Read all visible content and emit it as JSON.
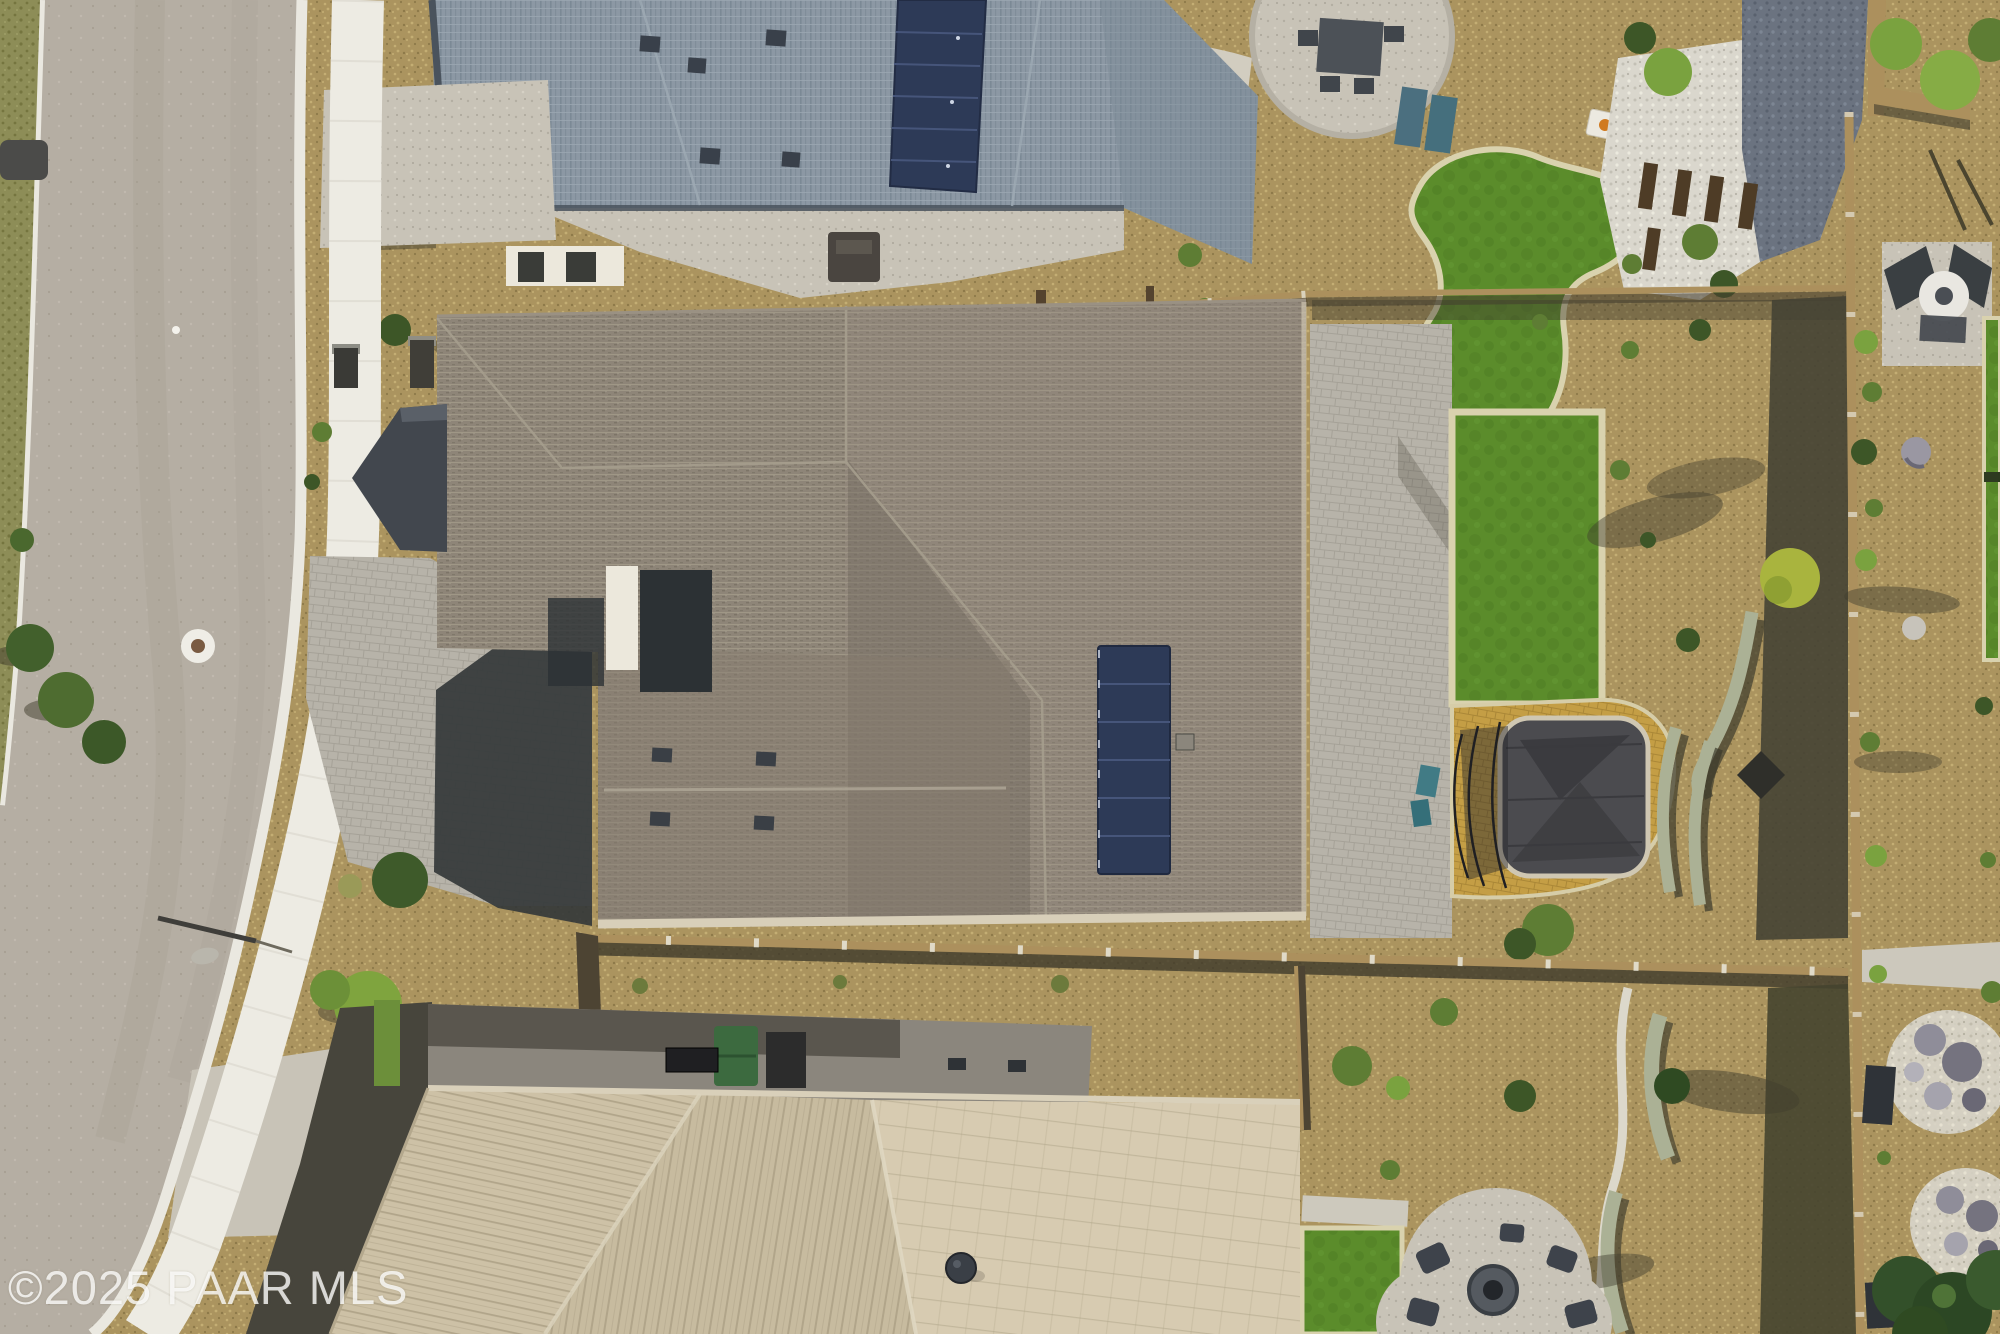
{
  "photo": {
    "type": "aerial-drone-photograph",
    "subject": "residential neighborhood rooftops and backyards, top-down view",
    "watermark": "©2025 PAAR MLS"
  },
  "scene": {
    "road": "curved street with white curbs and sidewalk on left",
    "houses": [
      {
        "label": "blue-gray shingle roof house with solar panels",
        "position": "top"
      },
      {
        "label": "taupe shingle roof house with solar panel strip and white courtyard",
        "position": "center"
      },
      {
        "label": "tan tile roof house with flat utility roof",
        "position": "bottom"
      }
    ],
    "features": [
      "solar-panel-array-top-roof",
      "solar-panel-array-center-roof",
      "artificial-turf-lawn",
      "putting-green-with-cornhole-boards",
      "trampoline-with-net",
      "fire-pit-patio-with-chairs",
      "circular-paver-patio-with-dining-set",
      "round-white-table-under-pergola",
      "desert-gravel-landscaping",
      "privacy-walls-and-fences",
      "serpentine-seat-walls",
      "rock-gardens",
      "street-light",
      "manhole-cover",
      "green-trash-bin",
      "blue-trash-bin",
      "rooftop-dumpster",
      "satellite-dish"
    ]
  },
  "palette": {
    "road": "#b5aea3",
    "road-dark": "#a79f93",
    "curb": "#eae8e0",
    "sidewalk": "#edebe3",
    "concrete": "#c8c3b7",
    "pavers": "#b7b3a9",
    "paver-line": "#a5a197",
    "gravel": "#ab945f",
    "gravel-light": "#c4ae74",
    "gravel-dark": "#8d7949",
    "grass": "#8d8d57",
    "grass-dark": "#75753f",
    "shadow": "#413d2e",
    "roof-blue": "#8c98a4",
    "roof-blue-dark": "#7b8995",
    "roof-blue-deep": "#4a535d",
    "solar": "#2d3a57",
    "solar-line": "#46557a",
    "roof-taupe": "#8e8578",
    "roof-taupe-dark": "#7c7467",
    "roof-taupe-deep": "#5f584d",
    "gable-slate": "#42474e",
    "eave": "#d8cfb9",
    "white-wall": "#ece8dc",
    "tile": "#cdc1a6",
    "tile-line": "#b1a58a",
    "tile-light": "#d7cbb1",
    "flat-roof": "#8b867d",
    "flat-roof-dark": "#5a564e",
    "fence-tan": "#ac905d",
    "fence-dark": "#4d4433",
    "turf": "#5b8c2b",
    "turf-dark": "#4e7b24",
    "turf-border": "#d9d2ae",
    "amber": "#c49e45",
    "amber-line": "#aa8737",
    "green-bright": "#7aa23f",
    "green-mid": "#5e7d34",
    "green-dark": "#3d5627",
    "green-deep": "#2f4a22",
    "white-rock": "#dad7cd",
    "slate": "#6b7380",
    "slate-dark": "#59616e",
    "boulder": "#9a97a2",
    "bench": "#abb195",
    "trampoline": "#4b4b4f",
    "tramp-dark": "#2c2c30",
    "bin-green": "#3da344",
    "bin-blue": "#2b57b4",
    "teal": "#417b85",
    "table": "#e9e7e1",
    "metal-dark": "#3c4147"
  }
}
